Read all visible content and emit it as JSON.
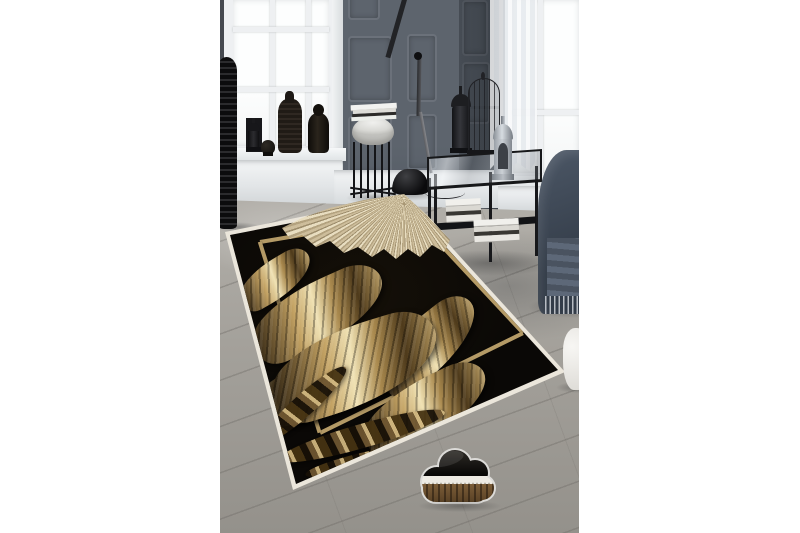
{
  "page": {
    "background": "#ffffff",
    "canvas_width": 800,
    "canvas_height": 533
  },
  "photo": {
    "left": 220,
    "top": 0,
    "width": 359,
    "height": 533,
    "description": "Styled interior product photo: black area rug with gold acanthus-leaf and fringe-feather motif and gold frame border, lying on a grey plank floor between two white sash windows and dark grey panelled walls"
  },
  "palette": {
    "page-bg": "#ffffff",
    "wall-mid": "#5d646d",
    "wall-dark": "#3a4047",
    "trim": "#eef0f2",
    "glass": "#fdfefe",
    "floor-a": "#b2afa9",
    "floor-b": "#94918b",
    "rug-black": "#0a0806",
    "rug-edge": "#ebe6db",
    "rug-gold": "#b49a66",
    "leaf-gold": "#c3a263",
    "leaf-light": "#f0e2b4",
    "feather": "#cdbd9b",
    "metal-black": "#17181b",
    "chair-blue": "#3f4957",
    "marble": "#e6e6e3",
    "wood-brown": "#6b4f2c"
  },
  "objects": [
    {
      "name": "area-rug",
      "label": "Black rug with gold leaves, gold border, white edge binding and gold fringe feather"
    },
    {
      "name": "left-window",
      "label": "White sash window with muntin grid"
    },
    {
      "name": "right-window",
      "label": "White sash window with sheer curtain"
    },
    {
      "name": "panelled-wall",
      "label": "Dark grey panelled wall / doors"
    },
    {
      "name": "ribbed-vase",
      "label": "Tall black ribbed floor vase"
    },
    {
      "name": "sill-ornaments",
      "label": "Black lantern, head figurine, textured bottle, Buddha statue on windowsill"
    },
    {
      "name": "plant-stand",
      "label": "Grey pouf-top wire plant stand with magazines"
    },
    {
      "name": "floor-lamp",
      "label": "Black articulated floor lamp with dome base"
    },
    {
      "name": "console-table",
      "label": "Black metal console with glass top, book stacks, lanterns and birdcage"
    },
    {
      "name": "armchair",
      "label": "Dark blue armchair with fringed throw"
    },
    {
      "name": "white-planter",
      "label": "White round planter at right edge"
    },
    {
      "name": "cloud-decor",
      "label": "Cloud-shaped decor piece: black top, white lace band, wood-stripe base"
    },
    {
      "name": "wood-floor",
      "label": "Grey wood plank floor"
    }
  ]
}
